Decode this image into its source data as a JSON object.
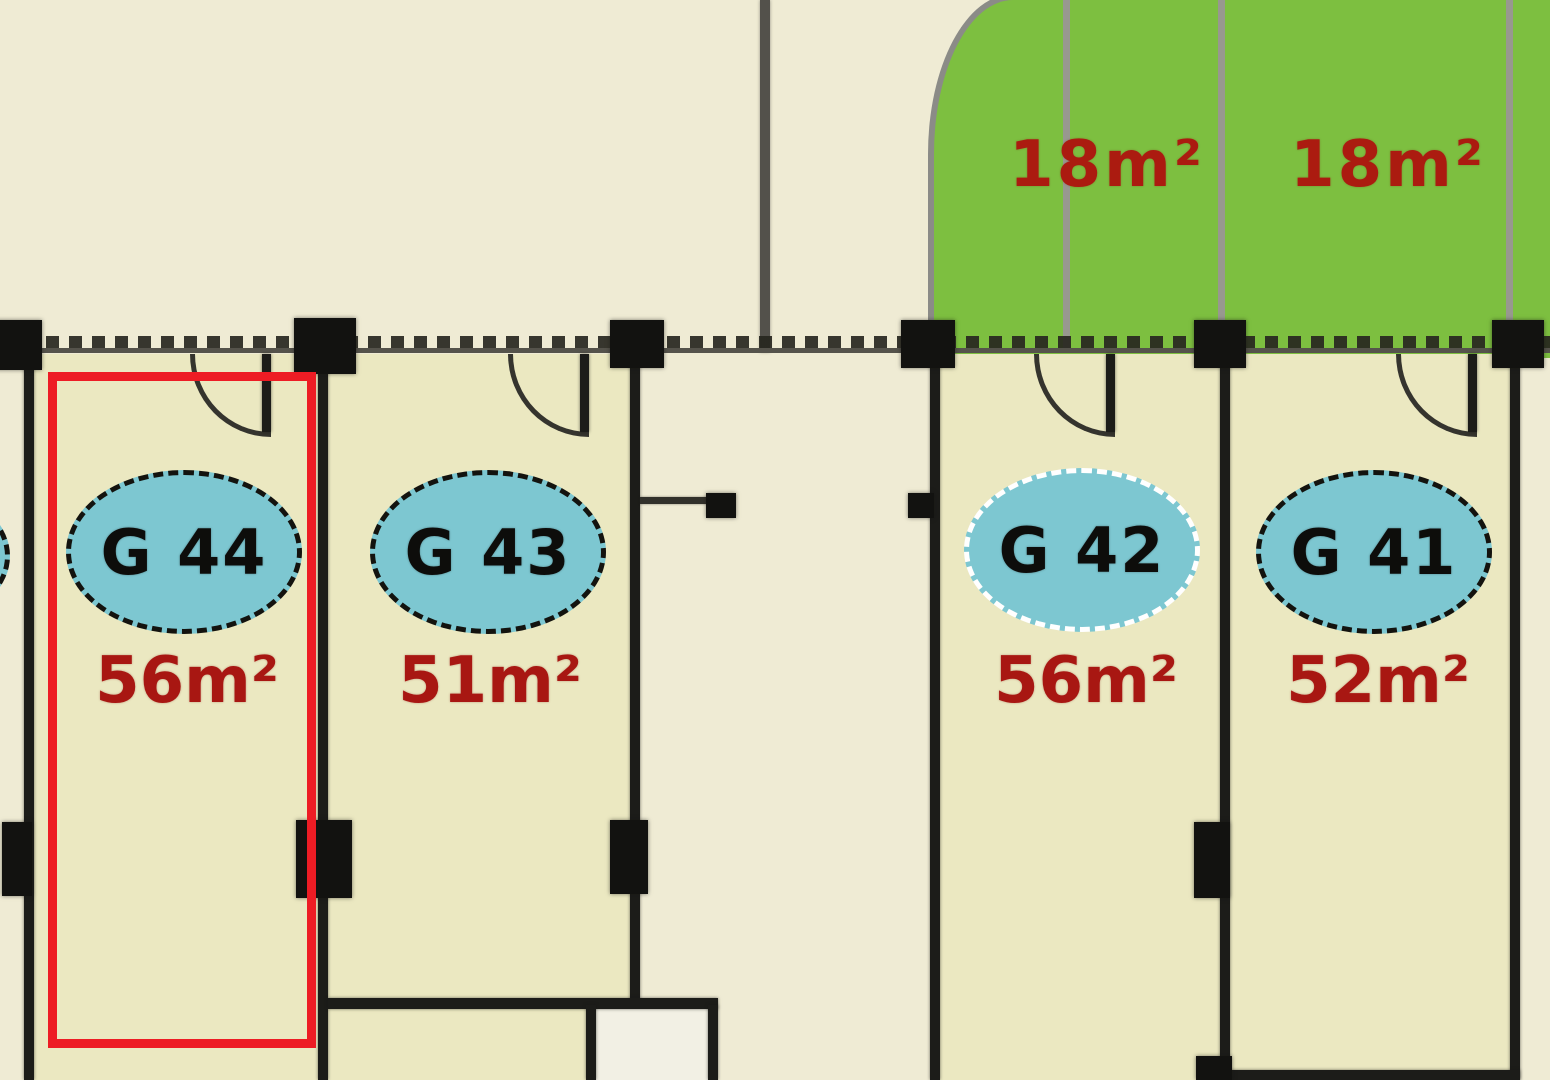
{
  "units": [
    {
      "id": "G 44",
      "area": "56m²",
      "selected": true
    },
    {
      "id": "G 43",
      "area": "51m²",
      "selected": false
    },
    {
      "id": "G 42",
      "area": "56m²",
      "selected": false
    },
    {
      "id": "G 41",
      "area": "52m²",
      "selected": false
    }
  ],
  "gardens": [
    {
      "area": "18m²"
    },
    {
      "area": "18m²"
    }
  ],
  "colors": {
    "background": "#efebd4",
    "unit_fill": "#ebe8c1",
    "garden_green": "#7dbf40",
    "badge_cyan": "#7dc7d1",
    "area_text_red": "#a81712",
    "garden_text_red": "#ab1b10",
    "highlight_red": "#ed1c24",
    "wall_dark": "#1c1c19",
    "wall_grey": "#53514b"
  }
}
